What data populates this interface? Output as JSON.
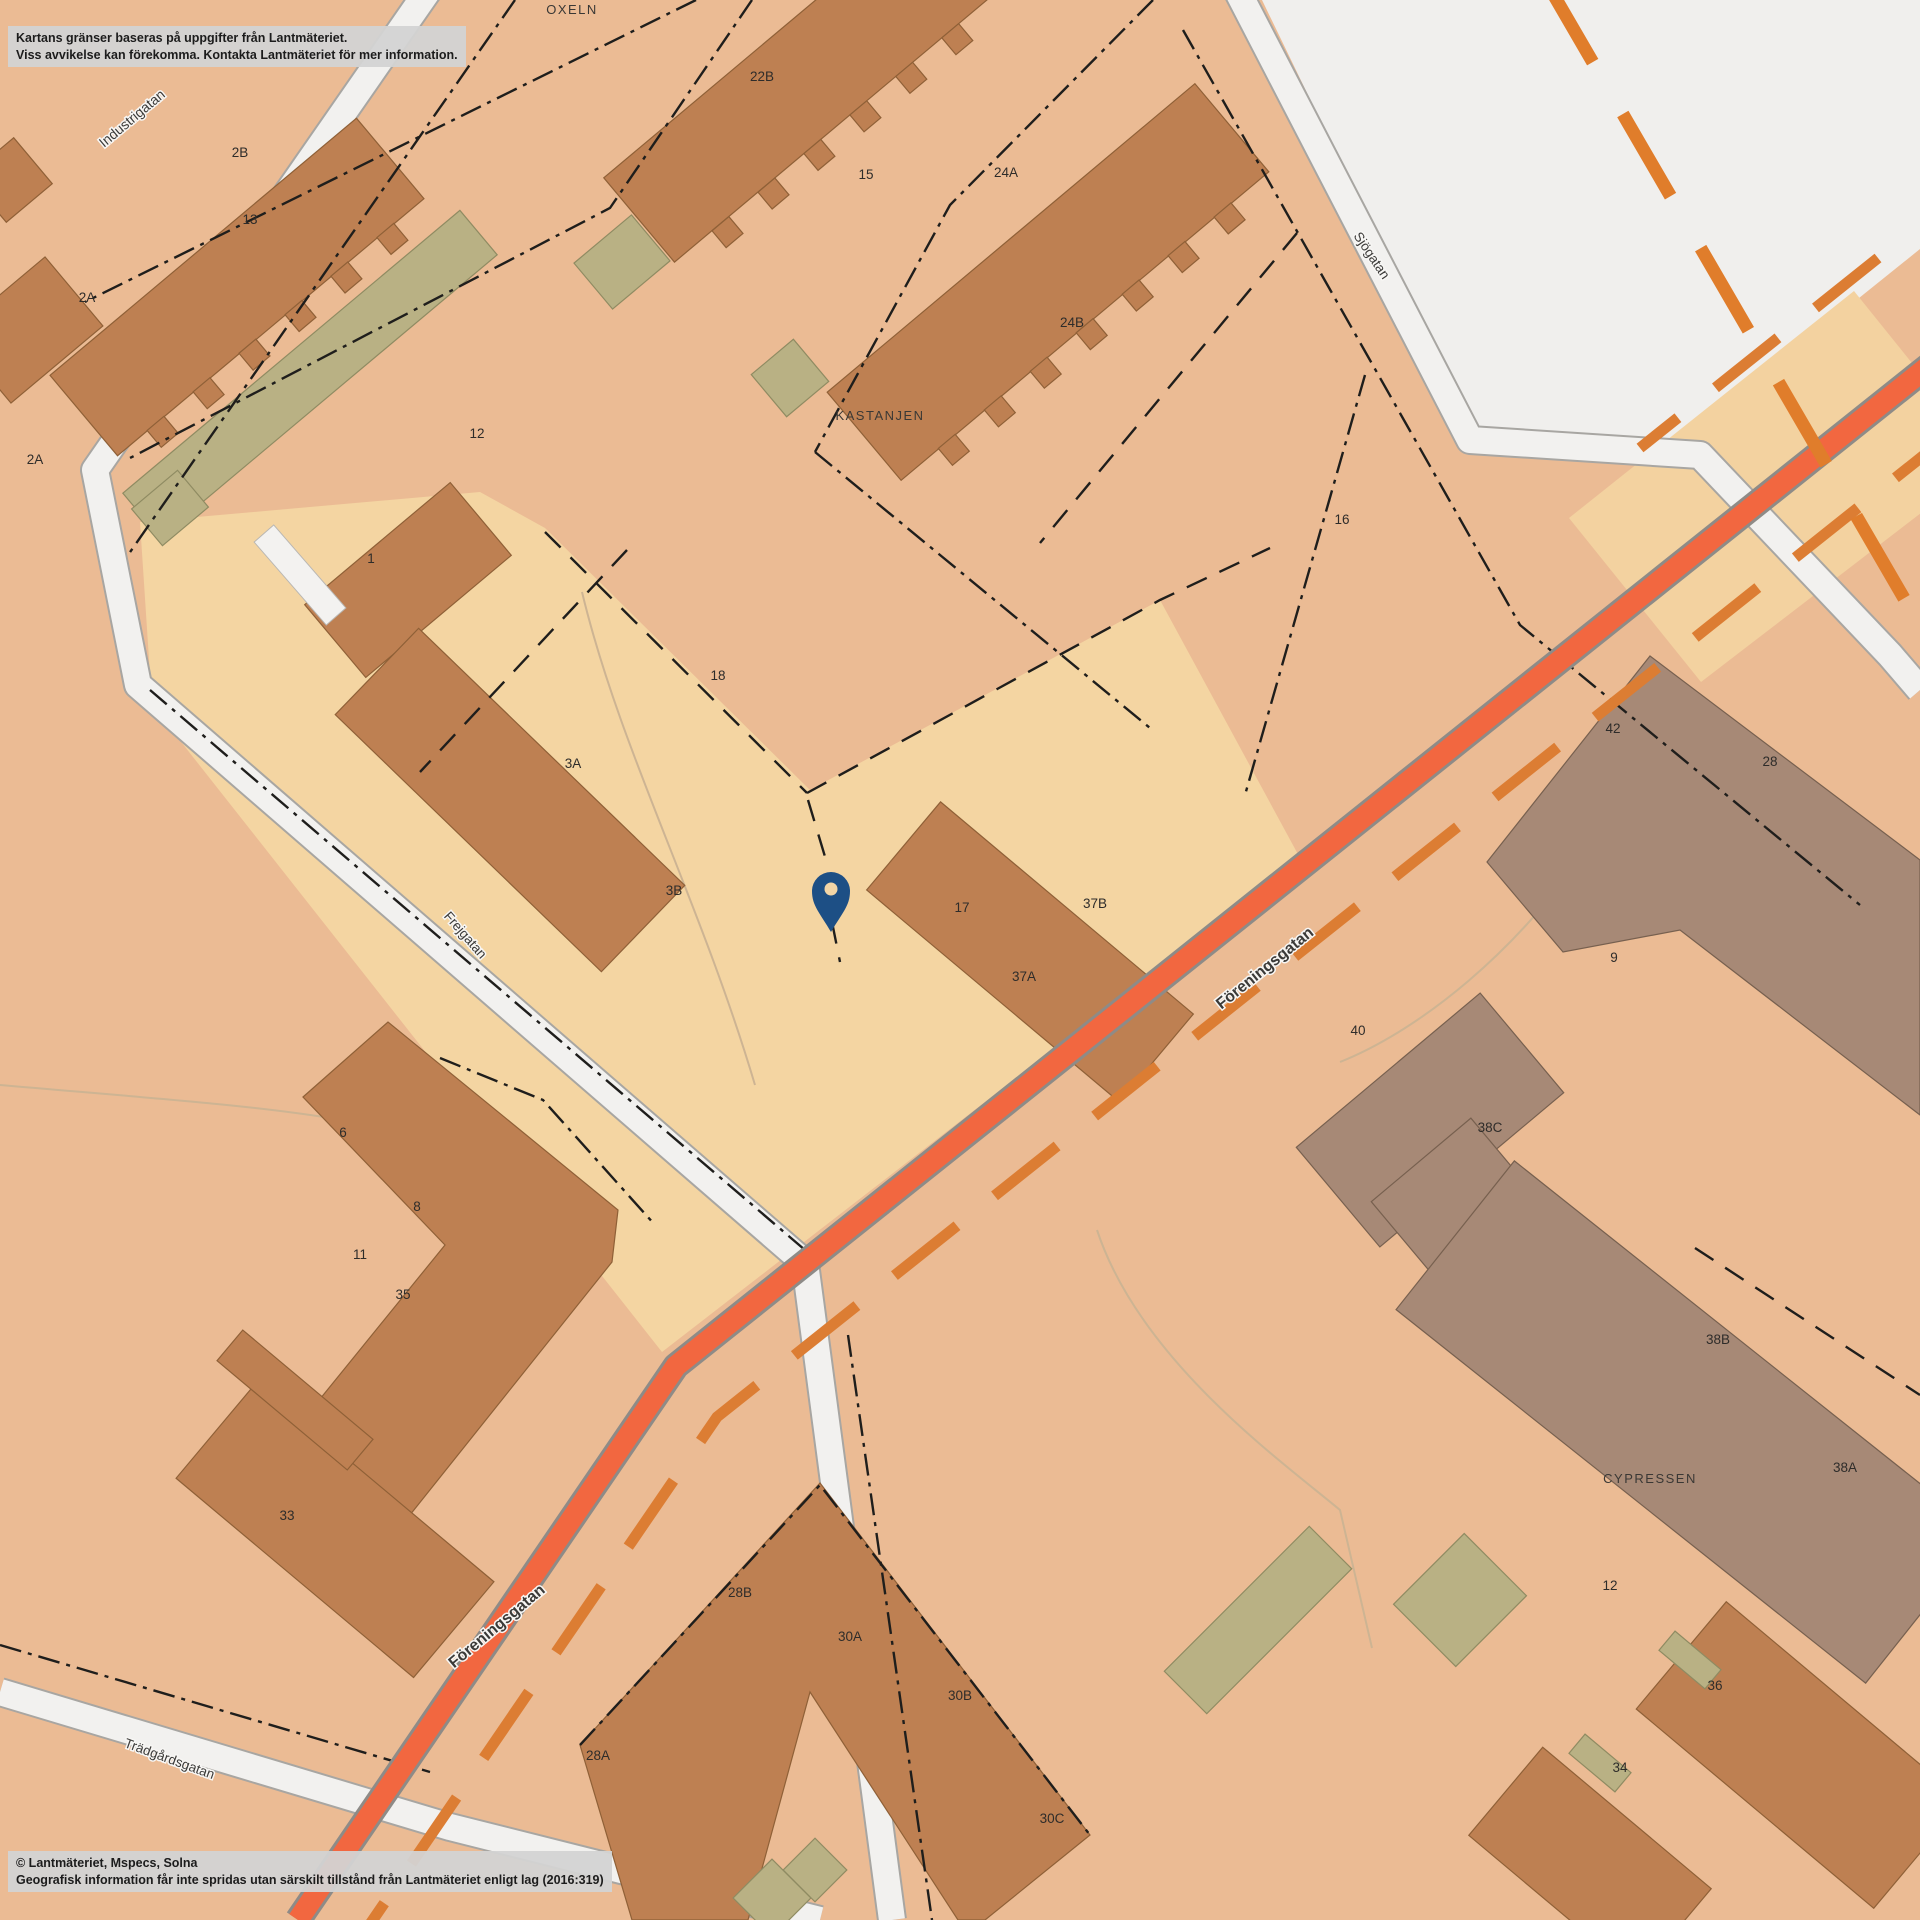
{
  "map": {
    "disclaimer": {
      "line1": "Kartans gränser baseras på uppgifter från Lantmäteriet.",
      "line2": "Viss avvikelse kan förekomma. Kontakta Lantmäteriet för mer information."
    },
    "attribution": {
      "line1": "© Lantmäteriet, Mspecs, Solna",
      "line2": "Geografisk information får inte spridas utan särskilt tillstånd från Lantmäteriet enligt lag (2016:319)"
    },
    "streets": [
      {
        "name": "Industrigatan",
        "x": 135,
        "y": 122,
        "rot": -40,
        "size": 14,
        "bold": false
      },
      {
        "name": "Sjögatan",
        "x": 1368,
        "y": 258,
        "rot": 56,
        "size": 13.5,
        "bold": false
      },
      {
        "name": "Föreningsgatan",
        "x": 1268,
        "y": 972,
        "rot": -39,
        "size": 16,
        "bold": true
      },
      {
        "name": "Föreningsgatan",
        "x": 500,
        "y": 1630,
        "rot": -40,
        "size": 16,
        "bold": true
      },
      {
        "name": "Frejgatan",
        "x": 462,
        "y": 938,
        "rot": 49,
        "size": 13.5,
        "bold": false
      },
      {
        "name": "Trädgårdsgatan",
        "x": 168,
        "y": 1763,
        "rot": 20,
        "size": 13.5,
        "bold": false
      }
    ],
    "blocks": [
      {
        "name": "OXELN",
        "x": 572,
        "y": 14
      },
      {
        "name": "KASTANJEN",
        "x": 880,
        "y": 420
      },
      {
        "name": "CYPRESSEN",
        "x": 1650,
        "y": 1483
      }
    ],
    "parcels": [
      {
        "label": "2B",
        "x": 240,
        "y": 157
      },
      {
        "label": "13",
        "x": 250,
        "y": 224
      },
      {
        "label": "2A",
        "x": 87,
        "y": 302
      },
      {
        "label": "2A",
        "x": 35,
        "y": 464
      },
      {
        "label": "12",
        "x": 477,
        "y": 438
      },
      {
        "label": "1",
        "x": 371,
        "y": 563
      },
      {
        "label": "18",
        "x": 718,
        "y": 680
      },
      {
        "label": "3A",
        "x": 573,
        "y": 768
      },
      {
        "label": "3B",
        "x": 674,
        "y": 895
      },
      {
        "label": "17",
        "x": 962,
        "y": 912
      },
      {
        "label": "37B",
        "x": 1095,
        "y": 908
      },
      {
        "label": "37A",
        "x": 1024,
        "y": 981
      },
      {
        "label": "22B",
        "x": 762,
        "y": 81
      },
      {
        "label": "15",
        "x": 866,
        "y": 179
      },
      {
        "label": "24A",
        "x": 1006,
        "y": 177
      },
      {
        "label": "24B",
        "x": 1072,
        "y": 327
      },
      {
        "label": "16",
        "x": 1342,
        "y": 524
      },
      {
        "label": "42",
        "x": 1613,
        "y": 733
      },
      {
        "label": "28",
        "x": 1770,
        "y": 766
      },
      {
        "label": "9",
        "x": 1614,
        "y": 962
      },
      {
        "label": "40",
        "x": 1358,
        "y": 1035
      },
      {
        "label": "38C",
        "x": 1490,
        "y": 1132
      },
      {
        "label": "38B",
        "x": 1718,
        "y": 1344
      },
      {
        "label": "38A",
        "x": 1845,
        "y": 1472
      },
      {
        "label": "12",
        "x": 1610,
        "y": 1590
      },
      {
        "label": "36",
        "x": 1715,
        "y": 1690
      },
      {
        "label": "34",
        "x": 1620,
        "y": 1772
      },
      {
        "label": "6",
        "x": 343,
        "y": 1137
      },
      {
        "label": "8",
        "x": 417,
        "y": 1211
      },
      {
        "label": "11",
        "x": 360,
        "y": 1259
      },
      {
        "label": "35",
        "x": 403,
        "y": 1299
      },
      {
        "label": "33",
        "x": 287,
        "y": 1520
      },
      {
        "label": "28B",
        "x": 740,
        "y": 1597
      },
      {
        "label": "30A",
        "x": 850,
        "y": 1641
      },
      {
        "label": "30B",
        "x": 960,
        "y": 1700
      },
      {
        "label": "28A",
        "x": 598,
        "y": 1760
      },
      {
        "label": "30C",
        "x": 1052,
        "y": 1823
      }
    ],
    "pin": {
      "x": 831,
      "y": 891,
      "color": "#1D4F85",
      "hole_color": "#F2D5A6"
    },
    "colors": {
      "background": "#EBBB94",
      "parcel_light": "#F4D5A2",
      "open_area": "#F0EFED",
      "road_orange": "#F26740",
      "road_dash_orange": "#DC7D33",
      "boundary_dash_orange": "#E07D2B",
      "street_white": "#F2F1EF",
      "building_brown": "#BE8052",
      "building_gray_brown": "#A78976",
      "building_olive": "#B9B184",
      "label_text": "#2E2C2A",
      "pin_blue": "#1D4F85"
    }
  }
}
